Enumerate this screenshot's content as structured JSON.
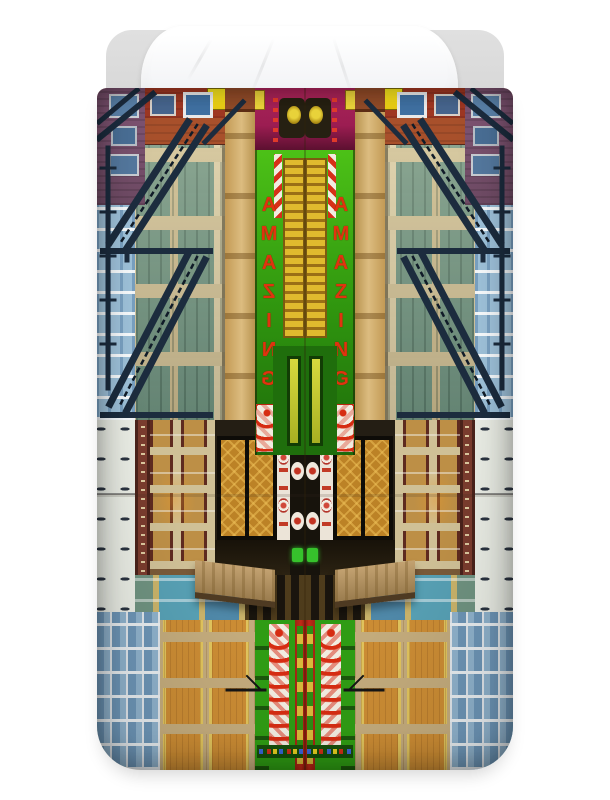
{
  "duvet": {
    "sign_text": "AMAZING"
  },
  "colors": {
    "page_bg": "#ffffff",
    "mattress": "#d7d7d7",
    "pillow": "#e7e9ed",
    "sign_red": "#e0330f",
    "candy_red": "#d63018",
    "candy_white": "#f2ece0",
    "magenta": "#9c1d52",
    "brick": "#9e3722",
    "brick_rust": "#a8502b",
    "purple_brick": "#6d4a63",
    "gold_panel": "#e0ba2e",
    "cream": "#d8caa3",
    "teal_glass": "#6f9280",
    "sky_glass": "#9dc0d8",
    "pale_wall": "#e9ece4",
    "khaki": "#cfc096",
    "amber": "#c1872e",
    "store_glass": "#bc8226",
    "sign_white": "#ece4d8",
    "stone": "#c3ab7c",
    "stone_glass": "#cb8c34",
    "glass_blue": "#6d95b6",
    "bottom_green": "#2f9c14",
    "bottom_red": "#c02a17",
    "escape": "#1c2c3e"
  }
}
